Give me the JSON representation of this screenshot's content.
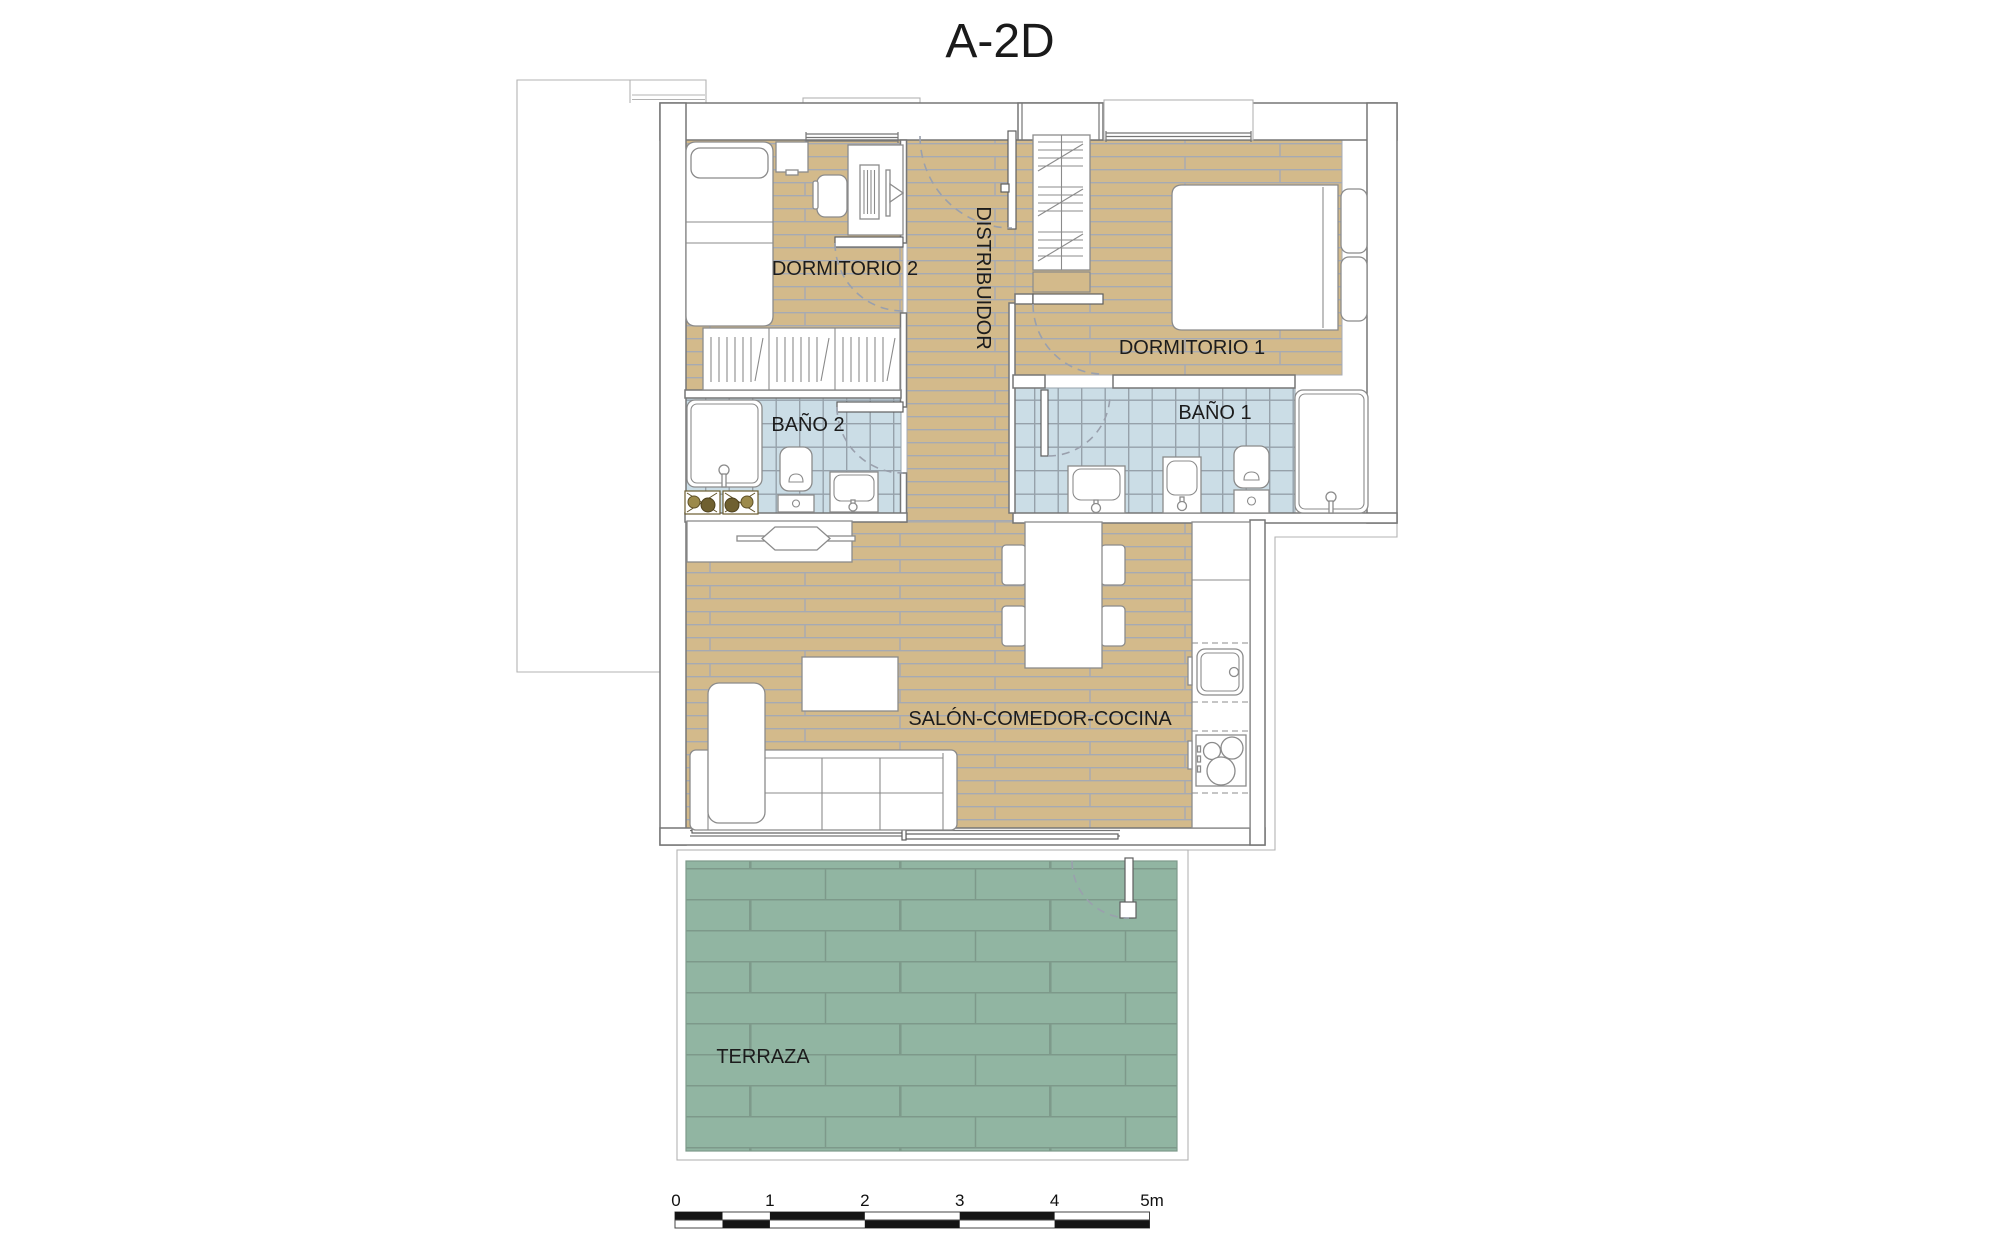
{
  "title": "A-2D",
  "rooms": [
    {
      "id": "dormitorio2",
      "label": "DORMITORIO 2"
    },
    {
      "id": "dormitorio1",
      "label": "DORMITORIO 1"
    },
    {
      "id": "distribuidor",
      "label": "DISTRIBUIDOR"
    },
    {
      "id": "bano2",
      "label": "BAÑO 2"
    },
    {
      "id": "bano1",
      "label": "BAÑO 1"
    },
    {
      "id": "salon",
      "label": "SALÓN-COMEDOR-COCINA"
    },
    {
      "id": "terraza",
      "label": "TERRAZA"
    }
  ],
  "scale_bar": {
    "unit": "m",
    "tick_labels": [
      "0",
      "1",
      "2",
      "3",
      "4",
      "5m"
    ]
  },
  "colors": {
    "wood_floor": "#d3ba8b",
    "floor_line": "#a6aab3",
    "bath_tile": "#cbdde6",
    "tile_line": "#96a1aa",
    "terrace_tile": "#91b5a2",
    "terrace_line": "#7d998a",
    "wall_line": "#767676",
    "exterior_line": "#b3b3b3",
    "furniture_line": "#8b8b8b",
    "arc_line": "#9aa0ad",
    "scale_black": "#141414",
    "text_color": "#1c1c1c"
  }
}
